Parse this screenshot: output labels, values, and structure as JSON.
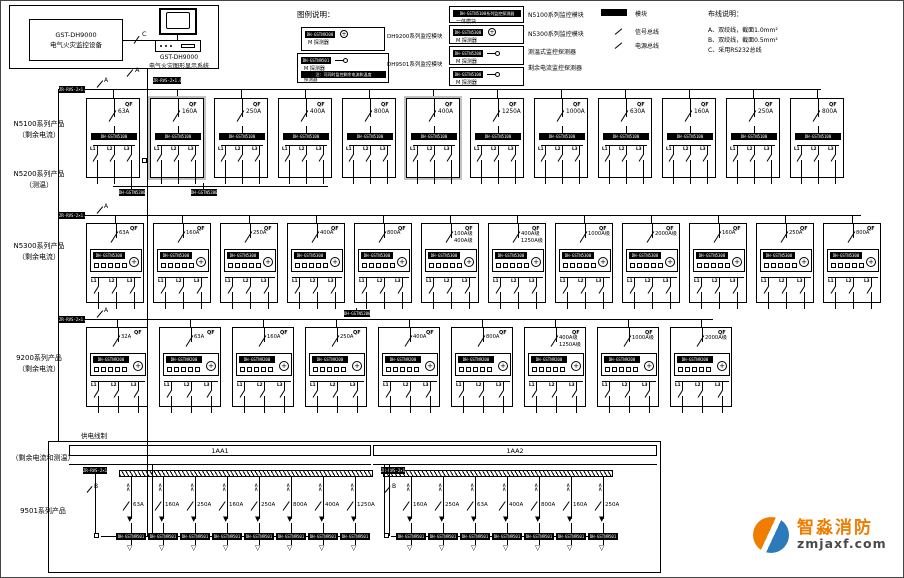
{
  "equipment": {
    "name_line1": "GST-DH9000",
    "name_line2": "电气火灾监控设备",
    "display_line1": "GST-DH9000",
    "display_line2": "电气火灾图形显示系统",
    "link_label": "C",
    "branch_label": "A",
    "panel_branch_label": "B"
  },
  "legend": {
    "title": "图例说明：",
    "left_items": [
      {
        "tag": "DH-GSTN9200",
        "symbol": "circle",
        "label": "M 探测器",
        "caption": "DH9200系列监控模块"
      },
      {
        "tag": "DH-GSTN9501",
        "symbol": "dash-circle",
        "label": "M 探测器",
        "note": "注：可同时监控剩余电流和温度",
        "note_label": "探测器",
        "caption": "DH9501系列监控模块"
      }
    ],
    "right_items": [
      {
        "tag": "DH-GSTN5100系列监控探测器",
        "symbol": "none",
        "label": "一体模块",
        "caption": "N5100系列监控模块"
      },
      {
        "tag": "DH-GSTN5300",
        "symbol": "circle",
        "label": "M 探测器",
        "caption": "N5300系列监控模块"
      },
      {
        "tag": "DH-GSTN5200",
        "symbol": "dash-circle",
        "label": "M 探测器",
        "caption": "测温式监控探测器"
      },
      {
        "tag": "DH-GSTN5100",
        "symbol": "dash-circle",
        "label": "M 探测器",
        "caption": "剩余电流监控探测器"
      }
    ],
    "mini_items": [
      {
        "symbol": "tag",
        "label": "模块"
      },
      {
        "symbol": "line",
        "label": "信号总线"
      },
      {
        "symbol": "line",
        "label": "电源总线"
      }
    ]
  },
  "wiring": {
    "title": "布线说明：",
    "items": [
      "A、双绞线，截面1.0mm²",
      "B、双绞线，截面0.5mm²",
      "C、采用RS232总线"
    ]
  },
  "bus_tag": "ZR-RVS-2×1.0",
  "breaker_tag": "QF",
  "phase_labels": [
    "L1",
    "L2",
    "L3"
  ],
  "rows": [
    {
      "label": [
        "N5100系列产品",
        "（剩余电流）"
      ],
      "module": "DH-GSTN5100",
      "boxes": [
        {
          "ratings": [
            "63A"
          ]
        },
        {
          "ratings": [
            "160A"
          ],
          "gray": true
        },
        {
          "ratings": [
            "250A"
          ]
        },
        {
          "ratings": [
            "400A"
          ]
        },
        {
          "ratings": [
            "800A"
          ]
        },
        {
          "ratings": [
            "400A"
          ],
          "gray": true
        },
        {
          "ratings": [
            "1250A"
          ]
        },
        {
          "ratings": [
            "1000A"
          ]
        },
        {
          "ratings": [
            "630A"
          ]
        },
        {
          "ratings": [
            "160A"
          ]
        },
        {
          "ratings": [
            "250A"
          ]
        },
        {
          "ratings": [
            "800A"
          ]
        }
      ]
    },
    {
      "label": [
        "N5300系列产品",
        "（剩余电流）"
      ],
      "module": "DH-GSTN5300",
      "boxes": [
        {
          "ratings": [
            "63A"
          ]
        },
        {
          "ratings": [
            "160A"
          ]
        },
        {
          "ratings": [
            "250A"
          ]
        },
        {
          "ratings": [
            "400A"
          ]
        },
        {
          "ratings": [
            "800A"
          ]
        },
        {
          "ratings": [
            "100A级",
            "400A级"
          ]
        },
        {
          "ratings": [
            "400A级",
            "1250A级"
          ]
        },
        {
          "ratings": [
            "1000A级"
          ]
        },
        {
          "ratings": [
            "2000A级"
          ]
        },
        {
          "ratings": [
            "160A"
          ]
        },
        {
          "ratings": [
            "250A"
          ]
        },
        {
          "ratings": [
            "800A"
          ]
        }
      ]
    },
    {
      "label": [
        "9200系列产品",
        "（剩余电流）"
      ],
      "module": "DH-GSTN9200",
      "boxes": [
        {
          "ratings": [
            "32A"
          ]
        },
        {
          "ratings": [
            "63A"
          ]
        },
        {
          "ratings": [
            "160A"
          ]
        },
        {
          "ratings": [
            "250A"
          ]
        },
        {
          "ratings": [
            "400A"
          ]
        },
        {
          "ratings": [
            "800A"
          ]
        },
        {
          "ratings": [
            "400A级",
            "1250A级"
          ]
        },
        {
          "ratings": [
            "1000A级"
          ]
        },
        {
          "ratings": [
            "2000A级"
          ]
        }
      ]
    }
  ],
  "mid_row_label": [
    "N5200系列产品",
    "（测温）"
  ],
  "mid_module": "DH-GSTN5200",
  "bottom": {
    "section_label": "供电线制",
    "area_label": "（剩余电流和测温）",
    "series_label": "9501系列产品",
    "feeder_module": "DH-GSTN9501",
    "panels": [
      {
        "title": "1AA1",
        "feeders": [
          "63A",
          "160A",
          "250A",
          "160A",
          "250A",
          "800A",
          "400A",
          "1250A"
        ]
      },
      {
        "title": "1AA2",
        "feeders": [
          "160A",
          "250A",
          "63A",
          "400A",
          "800A",
          "160A",
          "250A"
        ]
      }
    ]
  },
  "watermark": {
    "brand": "智淼消防",
    "url": "zmjaxf.com",
    "orange": "#f07c00",
    "blue": "#2b7bbb",
    "text_color": "#4a4a4a"
  }
}
